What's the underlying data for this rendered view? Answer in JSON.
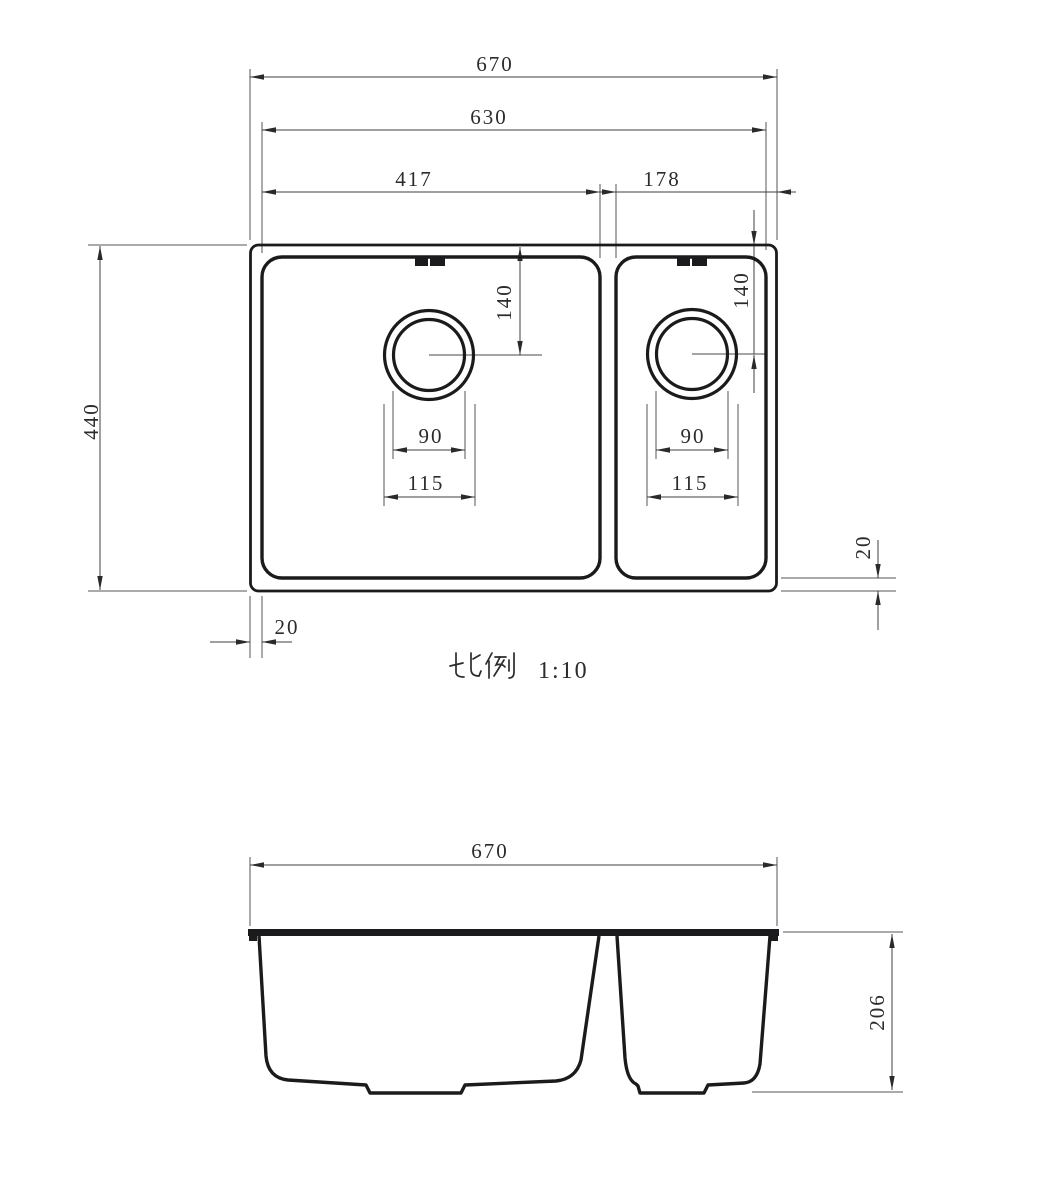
{
  "drawing": {
    "title_hint": "double-bowl sink dimensioned drawing",
    "line_color": "#1b1b1d",
    "dim_color": "#3f3f3f",
    "scale_note": {
      "label": "比例",
      "ratio": "1:10"
    },
    "top_view": {
      "dims": {
        "overall_width": "670",
        "opening_width": "630",
        "left_bowl_width": "417",
        "right_bowl_width": "178",
        "left_drain_from_top": "140",
        "right_drain_from_top": "140",
        "left_drain_inner_dia": "90",
        "left_drain_outer_dia": "115",
        "right_drain_inner_dia": "90",
        "right_drain_outer_dia": "115",
        "overall_depth": "440",
        "rim_width_left": "20",
        "rim_width_right_bottom": "20"
      }
    },
    "front_view": {
      "dims": {
        "overall_width": "670",
        "bowl_depth": "206"
      }
    }
  }
}
